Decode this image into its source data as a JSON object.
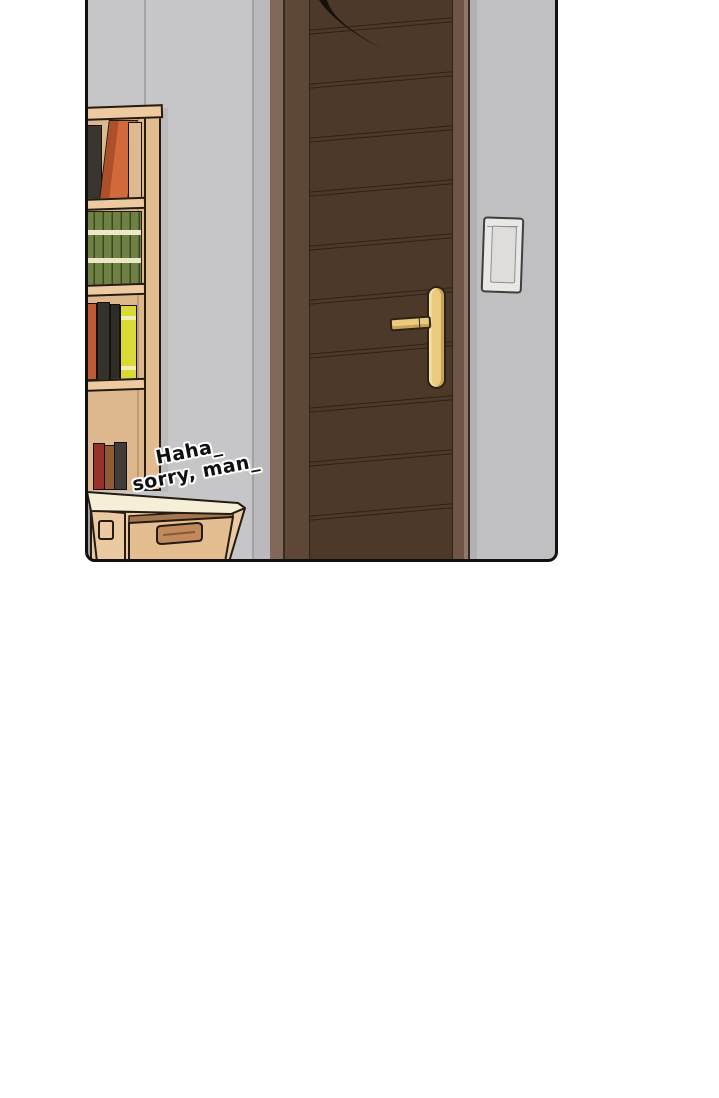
{
  "panel": {
    "kind": "webtoon-comic-panel",
    "speech": {
      "line1": "Haha_",
      "line2": "sorry, man_"
    },
    "scene_objects": [
      "gray-wall",
      "wooden-plank-door",
      "gold-door-handle",
      "light-switch",
      "bookshelf-with-books",
      "green-book-series",
      "desk-with-drawer",
      "drawer-handle",
      "dark-hanging-object-top-of-door"
    ]
  },
  "colors": {
    "page-bg": "#ffffff",
    "ink": "#111111",
    "wall-left": "#c6c5c7",
    "wall-mid": "#bbb9bb",
    "wall-right": "#c0bfc1",
    "seam": "#a3a2a5",
    "frame-light": "#826858",
    "frame-edge": "#8d7a6d",
    "outline-dark": "#3a2b20",
    "stile": "#5e4736",
    "stile-right": "#6e5545",
    "door-face": "#4d3929",
    "plank-line": "#2e2117",
    "handle-gold": "#e9ca7e",
    "handle-outline": "#2d2315",
    "switch-plate": "#e9e8e6",
    "switch-inner": "#dedddb",
    "wood": "#edca9f",
    "wood-side": "#e2bc8f",
    "wood-interior": "#ddb88e",
    "outline": "#241c12",
    "book-black": "#39352f",
    "book-orange": "#d2693a",
    "book-orange-dark": "#ad4f28",
    "book-tan": "#dcba8e",
    "book-green": "#6e8044",
    "book-stripe": "#ede8c8",
    "book-orange2": "#c05a35",
    "book-dark1": "#35312c",
    "book-dark2": "#2f2c28",
    "book-yellow": "#d9da35",
    "book-yellow-stripe": "#efefb2",
    "small-red": "#97302a",
    "small-brown": "#8f5b33",
    "small-dark": "#403c38",
    "desk-top": "#f6efd8",
    "desk-front": "#ebc9a1",
    "drawer-face": "#e4bd90",
    "drawer-rail": "#a5764e",
    "drawer-handle": "#c18a5c",
    "shadow-strip": "#b3b1b4"
  }
}
